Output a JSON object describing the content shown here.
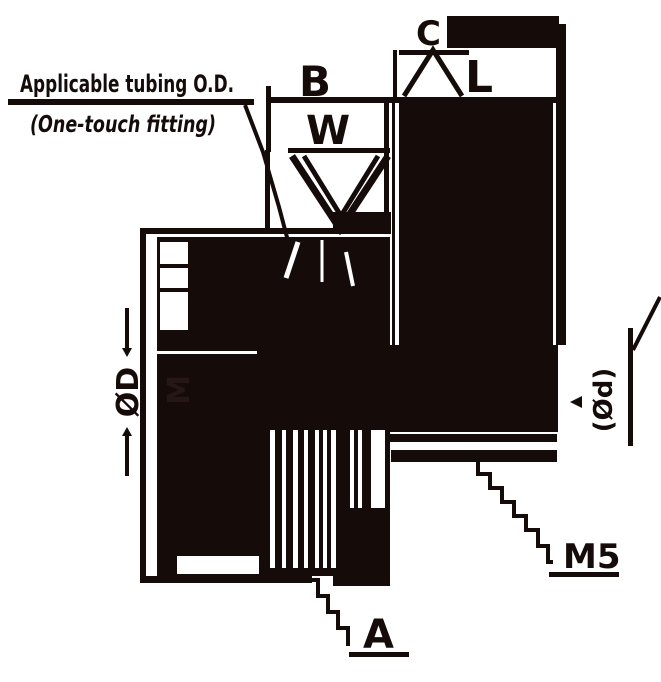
{
  "note": {
    "line1": "Applicable tubing O.D.",
    "line2": "(One-touch fitting)"
  },
  "dims": {
    "b": "B",
    "w": "W",
    "c": "C",
    "l": "L",
    "a": "A",
    "thread": "M5",
    "left_outer": "ØD",
    "left_inner": "M",
    "right_vertical": "(Ød)"
  },
  "colors": {
    "ink": "#150c0a",
    "background": "#ffffff"
  }
}
